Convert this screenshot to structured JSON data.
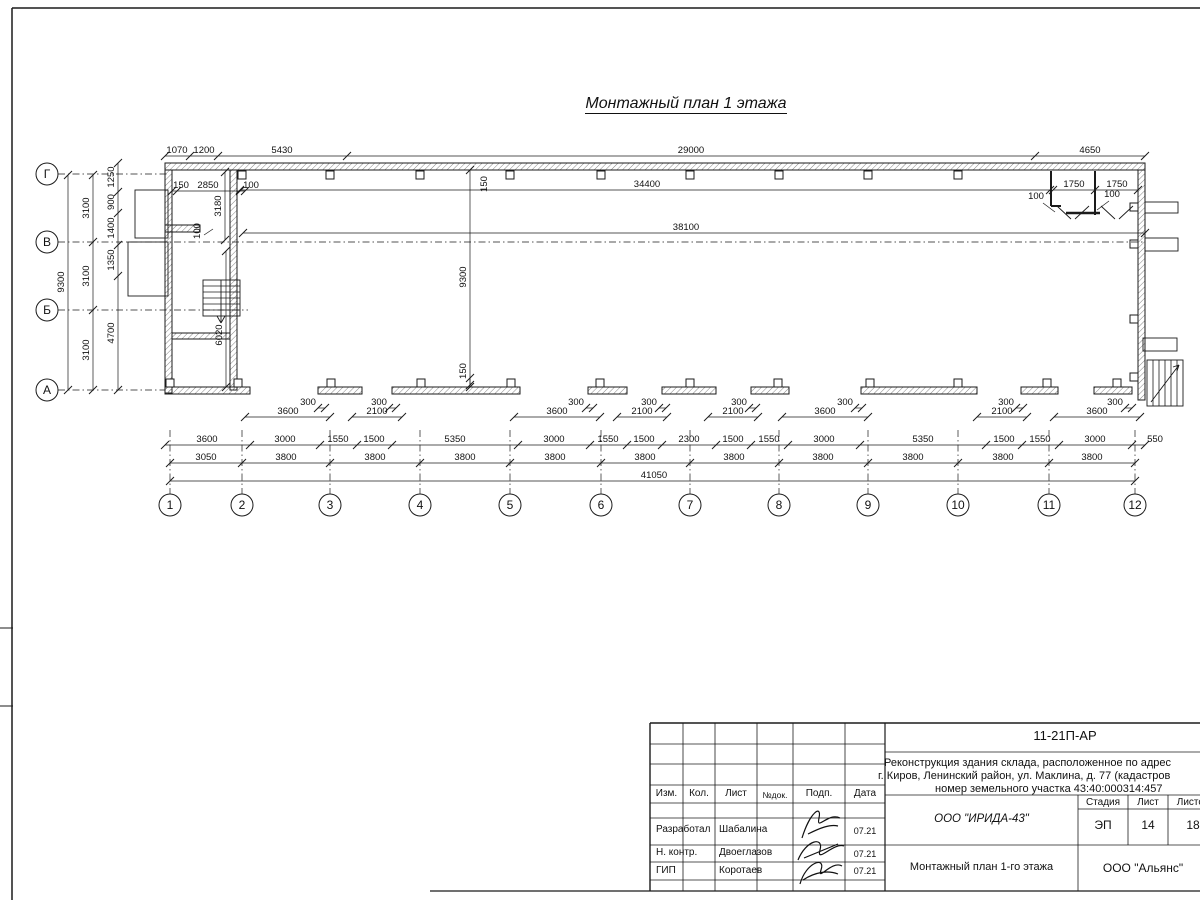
{
  "sheet": {
    "title": "Монтажный план 1 этажа"
  },
  "axes": {
    "left": [
      [
        "Г",
        174
      ],
      [
        "В",
        242
      ],
      [
        "Б",
        310
      ],
      [
        "А",
        390
      ]
    ],
    "bottom": [
      [
        "1",
        170
      ],
      [
        "2",
        242
      ],
      [
        "3",
        330
      ],
      [
        "4",
        420
      ],
      [
        "5",
        510
      ],
      [
        "6",
        601
      ],
      [
        "7",
        690
      ],
      [
        "8",
        779
      ],
      [
        "9",
        868
      ],
      [
        "10",
        958
      ],
      [
        "11",
        1049
      ],
      [
        "12",
        1135
      ]
    ]
  },
  "plan": {
    "walls": [
      [
        165,
        163,
        980,
        7
      ],
      [
        1138,
        170,
        7,
        230
      ],
      [
        165,
        170,
        7,
        223
      ],
      [
        230,
        170,
        7,
        220
      ],
      [
        165,
        225,
        35,
        7
      ],
      [
        172,
        333,
        58,
        6
      ],
      [
        165,
        387,
        85,
        7
      ],
      [
        318,
        387,
        44,
        7
      ],
      [
        392,
        387,
        128,
        7
      ],
      [
        588,
        387,
        39,
        7
      ],
      [
        662,
        387,
        54,
        7
      ],
      [
        751,
        387,
        38,
        7
      ],
      [
        861,
        387,
        116,
        7
      ],
      [
        1021,
        387,
        37,
        7
      ],
      [
        1094,
        387,
        38,
        7
      ]
    ],
    "boxes": [
      [
        135,
        190,
        33,
        48
      ],
      [
        128,
        242,
        40,
        54
      ],
      [
        1145,
        202,
        33,
        11
      ],
      [
        1145,
        238,
        33,
        13
      ],
      [
        1143,
        338,
        34,
        13
      ],
      [
        1147,
        360,
        36,
        46
      ],
      [
        203,
        280,
        37,
        36
      ]
    ],
    "squares": [
      [
        242,
        175
      ],
      [
        330,
        175
      ],
      [
        420,
        175
      ],
      [
        510,
        175
      ],
      [
        601,
        175
      ],
      [
        690,
        175
      ],
      [
        779,
        175
      ],
      [
        868,
        175
      ],
      [
        958,
        175
      ],
      [
        1134,
        207
      ],
      [
        1134,
        244
      ],
      [
        1134,
        319
      ],
      [
        1134,
        377
      ],
      [
        170,
        383
      ],
      [
        238,
        383
      ],
      [
        331,
        383
      ],
      [
        421,
        383
      ],
      [
        511,
        383
      ],
      [
        600,
        383
      ],
      [
        690,
        383
      ],
      [
        778,
        383
      ],
      [
        870,
        383
      ],
      [
        958,
        383
      ],
      [
        1047,
        383
      ],
      [
        1117,
        383
      ]
    ],
    "lines": [
      [
        12,
        8,
        1200,
        8,
        1.5
      ],
      [
        12,
        8,
        12,
        900,
        1.5
      ],
      [
        0,
        628,
        13,
        628,
        1
      ],
      [
        0,
        706,
        13,
        706,
        1
      ],
      [
        430,
        891,
        1200,
        891,
        1.3
      ],
      [
        650,
        723,
        1200,
        723,
        1.4
      ],
      [
        650,
        723,
        650,
        891,
        1.4
      ],
      [
        683,
        723,
        683,
        891,
        0.8
      ],
      [
        715,
        723,
        715,
        891,
        0.8
      ],
      [
        757,
        723,
        757,
        891,
        0.8
      ],
      [
        793,
        723,
        793,
        891,
        0.8
      ],
      [
        845,
        723,
        845,
        891,
        0.8
      ],
      [
        885,
        723,
        885,
        891,
        1.2
      ],
      [
        650,
        744,
        885,
        744,
        0.8
      ],
      [
        650,
        764,
        885,
        764,
        0.8
      ],
      [
        650,
        785,
        885,
        785,
        0.8
      ],
      [
        650,
        803,
        885,
        803,
        0.8
      ],
      [
        650,
        818,
        885,
        818,
        0.8
      ],
      [
        650,
        845,
        885,
        845,
        0.8
      ],
      [
        650,
        862,
        885,
        862,
        0.8
      ],
      [
        650,
        880,
        885,
        880,
        0.8
      ],
      [
        885,
        752,
        1200,
        752,
        0.8
      ],
      [
        885,
        795,
        1200,
        795,
        0.8
      ],
      [
        885,
        845,
        1200,
        845,
        0.8
      ],
      [
        1078,
        795,
        1078,
        891,
        0.8
      ],
      [
        1128,
        795,
        1128,
        845,
        0.8
      ],
      [
        1168,
        795,
        1168,
        845,
        0.8
      ],
      [
        1078,
        809,
        1200,
        809,
        0.8
      ],
      [
        203,
        286,
        240,
        286,
        0.8
      ],
      [
        203,
        292,
        240,
        292,
        0.8
      ],
      [
        203,
        298,
        240,
        298,
        0.8
      ],
      [
        203,
        304,
        240,
        304,
        0.8
      ],
      [
        203,
        310,
        240,
        310,
        0.8
      ],
      [
        221,
        280,
        221,
        322,
        0.9
      ],
      [
        217,
        316,
        221,
        323,
        0.9
      ],
      [
        225,
        316,
        221,
        323,
        0.9
      ],
      [
        1153,
        360,
        1153,
        406,
        0.8
      ],
      [
        1159,
        360,
        1159,
        406,
        0.8
      ],
      [
        1165,
        360,
        1165,
        406,
        0.8
      ],
      [
        1171,
        360,
        1171,
        406,
        0.8
      ],
      [
        1177,
        360,
        1177,
        406,
        0.8
      ],
      [
        1151,
        402,
        1179,
        365,
        0.9
      ],
      [
        1173,
        367,
        1179,
        365,
        0.9
      ],
      [
        1177,
        371,
        1179,
        365,
        0.9
      ],
      [
        1051,
        171,
        1051,
        206,
        2
      ],
      [
        1051,
        206,
        1061,
        206,
        2
      ],
      [
        1095,
        171,
        1095,
        215,
        2
      ],
      [
        1066,
        213,
        1100,
        213,
        2.5
      ],
      [
        1057,
        206,
        1071,
        219,
        0.9
      ],
      [
        1089,
        206,
        1075,
        219,
        0.9
      ],
      [
        1101,
        206,
        1115,
        219,
        0.9
      ],
      [
        1133,
        206,
        1119,
        219,
        0.9
      ],
      [
        1043,
        203,
        1055,
        212,
        0.7
      ],
      [
        1109,
        201,
        1097,
        210,
        0.7
      ],
      [
        204,
        235,
        213,
        229,
        0.7
      ]
    ],
    "dash": [
      [
        58,
        174,
        168,
        174
      ],
      [
        58,
        242,
        1145,
        242
      ],
      [
        58,
        310,
        248,
        310
      ],
      [
        58,
        390,
        165,
        390
      ],
      [
        170,
        430,
        170,
        494
      ],
      [
        242,
        430,
        242,
        494
      ],
      [
        330,
        430,
        330,
        494
      ],
      [
        420,
        430,
        420,
        494
      ],
      [
        510,
        430,
        510,
        494
      ],
      [
        601,
        430,
        601,
        494
      ],
      [
        690,
        430,
        690,
        494
      ],
      [
        779,
        430,
        779,
        494
      ],
      [
        868,
        430,
        868,
        494
      ],
      [
        958,
        430,
        958,
        494
      ],
      [
        1049,
        430,
        1049,
        494
      ],
      [
        1135,
        430,
        1135,
        494
      ]
    ],
    "hdims": [
      {
        "y": 156,
        "x": [
          165,
          190,
          218,
          347,
          1035,
          1145
        ],
        "l": [
          [
            177,
            "1070"
          ],
          [
            204,
            "1200"
          ],
          [
            282,
            "5430"
          ],
          [
            691,
            "29000"
          ],
          [
            1090,
            "4650"
          ]
        ]
      },
      {
        "y": 191,
        "x": [
          172,
          177,
          240,
          245
        ],
        "l": [
          [
            181,
            "150"
          ],
          [
            208,
            "2850"
          ],
          [
            251,
            "100"
          ]
        ]
      },
      {
        "y": 190,
        "x": [
          1053,
          1095,
          1138
        ],
        "l": [
          [
            1074,
            "1750"
          ],
          [
            1117,
            "1750"
          ]
        ]
      },
      {
        "y": 190,
        "x": [
          240,
          1050
        ],
        "l": [
          [
            647,
            "34400"
          ]
        ]
      },
      {
        "y": 233,
        "x": [
          243,
          1145
        ],
        "l": [
          [
            686,
            "38100"
          ]
        ]
      },
      {
        "y": 417,
        "x": [
          245,
          330
        ],
        "l": [
          [
            288,
            "3600"
          ]
        ]
      },
      {
        "y": 417,
        "x": [
          352,
          402
        ],
        "l": [
          [
            377,
            "2100"
          ]
        ]
      },
      {
        "y": 417,
        "x": [
          514,
          600
        ],
        "l": [
          [
            557,
            "3600"
          ]
        ]
      },
      {
        "y": 417,
        "x": [
          617,
          667
        ],
        "l": [
          [
            642,
            "2100"
          ]
        ]
      },
      {
        "y": 417,
        "x": [
          708,
          758
        ],
        "l": [
          [
            733,
            "2100"
          ]
        ]
      },
      {
        "y": 417,
        "x": [
          782,
          868
        ],
        "l": [
          [
            825,
            "3600"
          ]
        ]
      },
      {
        "y": 417,
        "x": [
          977,
          1027
        ],
        "l": [
          [
            1002,
            "2100"
          ]
        ]
      },
      {
        "y": 417,
        "x": [
          1054,
          1140
        ],
        "l": [
          [
            1097,
            "3600"
          ]
        ]
      },
      {
        "y": 408,
        "x": [
          318,
          325
        ],
        "l": [
          [
            308,
            "300"
          ]
        ]
      },
      {
        "y": 408,
        "x": [
          389,
          396
        ],
        "l": [
          [
            379,
            "300"
          ]
        ]
      },
      {
        "y": 408,
        "x": [
          586,
          593
        ],
        "l": [
          [
            576,
            "300"
          ]
        ]
      },
      {
        "y": 408,
        "x": [
          659,
          666
        ],
        "l": [
          [
            649,
            "300"
          ]
        ]
      },
      {
        "y": 408,
        "x": [
          749,
          756
        ],
        "l": [
          [
            739,
            "300"
          ]
        ]
      },
      {
        "y": 408,
        "x": [
          855,
          862
        ],
        "l": [
          [
            845,
            "300"
          ]
        ]
      },
      {
        "y": 408,
        "x": [
          1016,
          1023
        ],
        "l": [
          [
            1006,
            "300"
          ]
        ]
      },
      {
        "y": 408,
        "x": [
          1125,
          1132
        ],
        "l": [
          [
            1115,
            "300"
          ]
        ]
      },
      {
        "y": 445,
        "x": [
          165,
          250,
          320,
          357,
          392,
          518,
          590,
          627,
          662,
          716,
          751,
          788,
          860,
          986,
          1022,
          1059,
          1132,
          1145
        ],
        "l": [
          [
            207,
            "3600"
          ],
          [
            285,
            "3000"
          ],
          [
            338,
            "1550"
          ],
          [
            374,
            "1500"
          ],
          [
            455,
            "5350"
          ],
          [
            554,
            "3000"
          ],
          [
            608,
            "1550"
          ],
          [
            644,
            "1500"
          ],
          [
            689,
            "2300"
          ],
          [
            733,
            "1500"
          ],
          [
            769,
            "1550"
          ],
          [
            824,
            "3000"
          ],
          [
            923,
            "5350"
          ],
          [
            1004,
            "1500"
          ],
          [
            1040,
            "1550"
          ],
          [
            1095,
            "3000"
          ],
          [
            1155,
            "550"
          ]
        ]
      },
      {
        "y": 463,
        "x": [
          170,
          242,
          330,
          420,
          510,
          601,
          690,
          779,
          868,
          958,
          1049,
          1135
        ],
        "l": [
          [
            206,
            "3050"
          ],
          [
            286,
            "3800"
          ],
          [
            375,
            "3800"
          ],
          [
            465,
            "3800"
          ],
          [
            555,
            "3800"
          ],
          [
            645,
            "3800"
          ],
          [
            734,
            "3800"
          ],
          [
            823,
            "3800"
          ],
          [
            913,
            "3800"
          ],
          [
            1003,
            "3800"
          ],
          [
            1092,
            "3800"
          ]
        ]
      },
      {
        "y": 481,
        "x": [
          170,
          1135
        ],
        "l": [
          [
            654,
            "41050"
          ]
        ]
      }
    ],
    "vdims": [
      {
        "x": 68,
        "y": [
          175,
          390
        ],
        "l": [
          [
            282,
            "9300"
          ]
        ]
      },
      {
        "x": 93,
        "y": [
          175,
          242,
          310,
          390
        ],
        "l": [
          [
            208,
            "3100"
          ],
          [
            276,
            "3100"
          ],
          [
            350,
            "3100"
          ]
        ]
      },
      {
        "x": 118,
        "y": [
          163,
          192,
          213,
          245,
          276,
          390
        ],
        "l": [
          [
            177,
            "1250"
          ],
          [
            202,
            "900"
          ],
          [
            228,
            "1400"
          ],
          [
            260,
            "1350"
          ],
          [
            333,
            "4700"
          ]
        ]
      },
      {
        "x": 470,
        "y": [
          170,
          385
        ],
        "l": [
          [
            277,
            "9300"
          ]
        ]
      },
      {
        "x": 470,
        "y": [
          378,
          387
        ],
        "l": [
          [
            371,
            "150"
          ]
        ]
      },
      {
        "x": 225,
        "y": [
          172,
          240
        ],
        "l": [
          [
            206,
            "3180"
          ]
        ]
      },
      {
        "x": 226,
        "y": [
          251,
          387
        ],
        "l": [
          [
            335,
            "6020"
          ]
        ]
      }
    ],
    "labels": [
      [
        1036,
        199,
        "100"
      ],
      [
        1112,
        197,
        "100"
      ]
    ],
    "rlabels": [
      [
        200,
        231,
        "100"
      ],
      [
        487,
        184,
        "150"
      ]
    ]
  },
  "titleblock": {
    "code": "11-21П-АР",
    "desc_line1": "Реконструкция здания склада, расположенное по адрес",
    "desc_line2": "г. Киров, Ленинский район, ул. Маклина, д. 77 (кадастров",
    "desc_line3": "номер земельного участка 43:40:000314:457",
    "header": {
      "izm": "Изм.",
      "kol": "Кол.",
      "list": "Лист",
      "ndok": "№док.",
      "podp": "Подп.",
      "data": "Дата"
    },
    "rows": [
      {
        "role": "Разработал",
        "name": "Шабалина",
        "date": "07.21"
      },
      {
        "role": "Н. контр.",
        "name": "Двоеглазов",
        "date": "07.21"
      },
      {
        "role": "ГИП",
        "name": "Коротаев",
        "date": "07.21"
      }
    ],
    "org": "ООО \"ИРИДА-43\"",
    "doc_title": "Монтажный план 1-го этажа",
    "company": "ООО \"Альянс\"",
    "stage_header": {
      "stadia": "Стадия",
      "list": "Лист",
      "listov": "Листов"
    },
    "stage_values": {
      "stadia": "ЭП",
      "list": "14",
      "listov": "18"
    }
  }
}
